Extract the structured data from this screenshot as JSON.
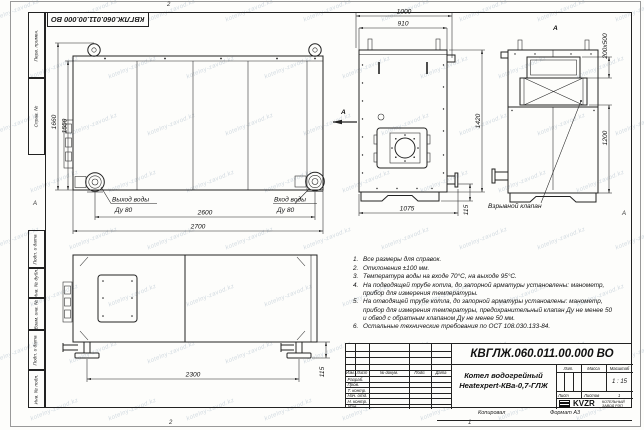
{
  "watermark": {
    "text": "kotelny-zavod.kz"
  },
  "stamp": {
    "doc_number": "КВГЛЖ.060.011.00.000 ВО"
  },
  "frame": {
    "left_labels": [
      "Перв. примен.",
      "Справ. №",
      "Подп. и дата",
      "Инв. № дубл.",
      "Взам. инв. №",
      "Подп. и дата",
      "Инв. № подл."
    ],
    "zone_top": "2",
    "zone_bottom_left": "2",
    "zone_bottom_right": "1",
    "fold_left": "А",
    "fold_right": "А"
  },
  "front_view": {
    "dim_height_overall": "1660",
    "dim_height_body": "1550",
    "dim_width_inner": "2600",
    "dim_width_overall": "2700",
    "outlet_label": "Выход воды",
    "outlet_dn": "Ду 80",
    "inlet_label": "Вход воды",
    "inlet_dn": "Ду 80",
    "view_arrow": "А"
  },
  "side_view": {
    "dim_top_overall": "1000",
    "dim_top_inner": "910",
    "dim_height": "1420",
    "dim_bottom": "1075",
    "dim_stub": "115"
  },
  "rear_view": {
    "view_label": "А",
    "dim_opening": "200х500",
    "dim_height": "1200",
    "callout": "Взрывной клапан"
  },
  "top_view": {
    "dim_length": "2300",
    "dim_foot": "115"
  },
  "notes": {
    "nums": [
      "1.",
      "2.",
      "3.",
      "4.",
      "5.",
      "6."
    ],
    "items": [
      "Все размеры для справок.",
      "Отклонения ±100 мм.",
      "Температура воды на входе 70°С, на выходе 95°С.",
      "На подводящей трубе котла, до запорной арматуры установлены: манометр, прибор для измерения температуры.",
      "На отводящей трубе котла, до запорной арматуры установлены: манометр, прибор для измерения температуры, предохранительный клапан Ду не менее 50 и обвод с обратным клапаном Ду не менее 50 мм.",
      "Остальные технические требования по ОСТ 108.030.133-84."
    ]
  },
  "title_block": {
    "doc_number": "КВГЛЖ.060.011.00.000 ВО",
    "product_line1": "Котел водогрейный",
    "product_line2": "Heatexpert-КВа-0,7-ГЛЖ",
    "columns": [
      "Изм.",
      "Лист",
      "№ докум.",
      "Подп.",
      "Дата"
    ],
    "rows": [
      "Разраб.",
      "Пров.",
      "Т. контр.",
      "Нач. отд.",
      "Н. контр.",
      "Утв."
    ],
    "lit_label": "Лит.",
    "mass_label": "Масса",
    "scale_label": "Масштаб",
    "scale_value": "1 : 15",
    "sheet_label": "Лист",
    "sheets_label": "Листов",
    "sheets_value": "1",
    "logo_text": "KVZR",
    "company_line1": "КОТЕЛЬНЫЙ",
    "company_line2": "ЗАВОД РЭП",
    "copied_label": "Копировал",
    "format_label": "Формат А3"
  }
}
